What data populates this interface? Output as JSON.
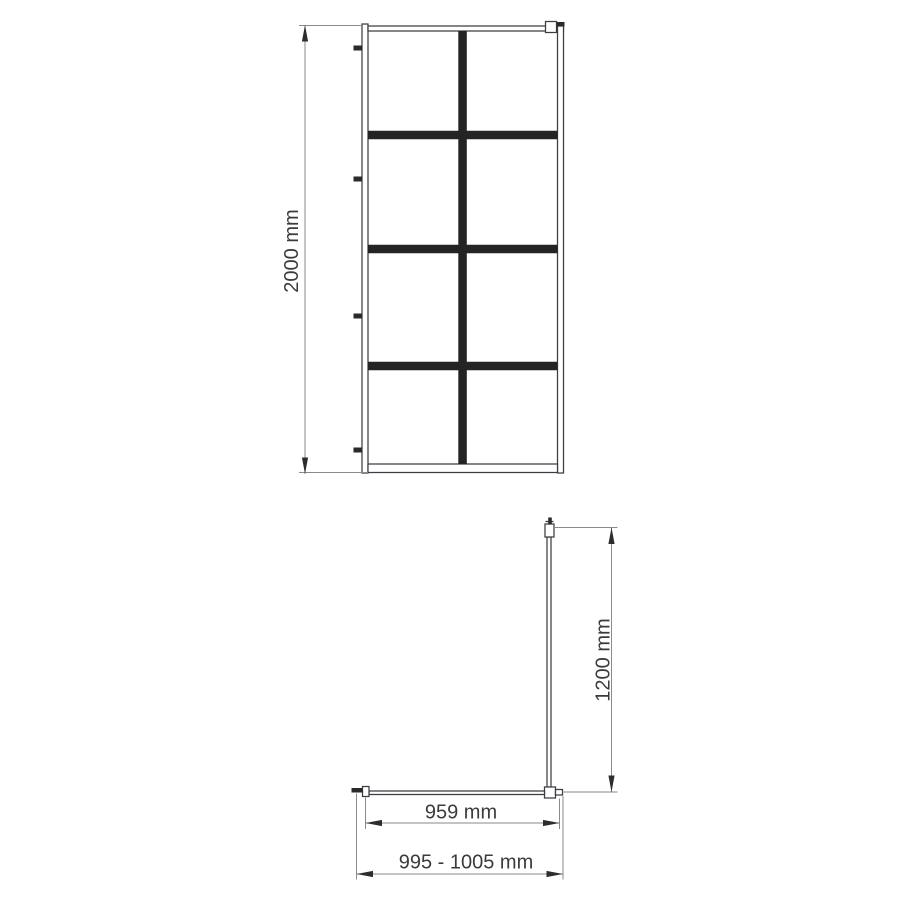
{
  "diagram": {
    "front_view": {
      "height_dimension": "2000 mm"
    },
    "plan_view": {
      "depth_dimension": "1200 mm",
      "glass_width_dimension": "959 mm",
      "installation_width_dimension": "995 - 1005 mm"
    },
    "colors": {
      "outline": "#3b3d42",
      "grid_bar": "#242424",
      "hardware": "#2a2a2a",
      "dimension_line": "#8a8a8a",
      "arrow": "#2d2d2d",
      "text": "#3b3b3b",
      "background": "#ffffff"
    }
  }
}
